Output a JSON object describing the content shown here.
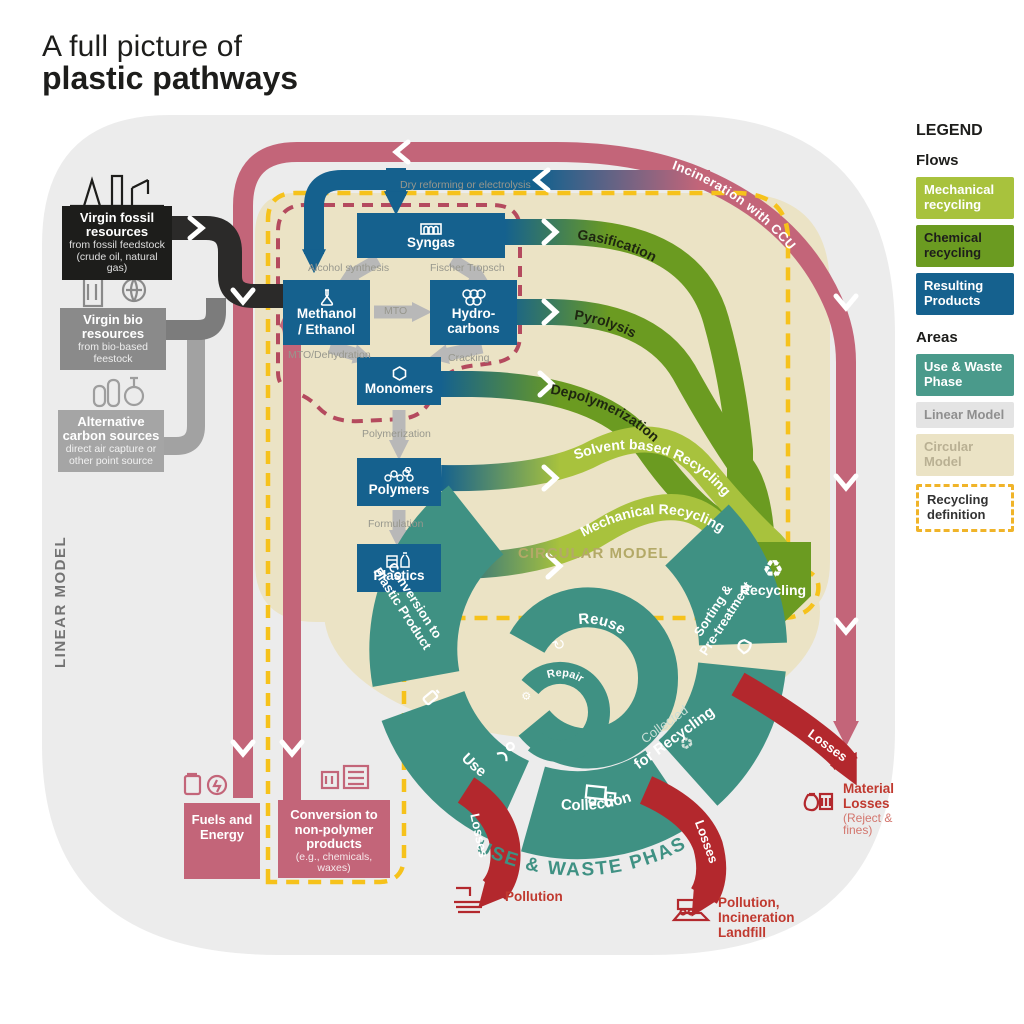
{
  "title": {
    "line1": "A full picture of",
    "line2": "plastic pathways"
  },
  "legend": {
    "title": "LEGEND",
    "flows_heading": "Flows",
    "flow_items": [
      {
        "label": "Mechanical recycling",
        "color": "#a8c23d"
      },
      {
        "label": "Chemical recycling",
        "color": "#6b9b21"
      },
      {
        "label": "Resulting Products",
        "color": "#15618e"
      }
    ],
    "areas_heading": "Areas",
    "area_items": [
      {
        "label": "Use & Waste Phase",
        "color": "#4a9a8b"
      },
      {
        "label": "Linear Model",
        "color": "#e4e4e4"
      },
      {
        "label": "Circular Model",
        "color": "#ebe3c5"
      },
      {
        "label": "Recycling definition",
        "color": "#ffffff"
      }
    ]
  },
  "sources": [
    {
      "title": "Virgin fossil resources",
      "subtitle": "from fossil feedstock (crude oil, natural gas)"
    },
    {
      "title": "Virgin bio resources",
      "subtitle": "from bio-based feestock"
    },
    {
      "title": "Alternative carbon sources",
      "subtitle": "direct air capture or other point source"
    }
  ],
  "areas": {
    "linear": "LINEAR MODEL",
    "circular": "CIRCULAR MODEL",
    "use_waste": "USE & WASTE PHASE"
  },
  "nodes": {
    "syngas": "Syngas",
    "methanol": [
      "Methanol",
      "/ Ethanol"
    ],
    "hydrocarbons": [
      "Hydro-",
      "carbons"
    ],
    "monomers": "Monomers",
    "polymers": "Polymers",
    "plastics": "Plastics"
  },
  "process_labels": {
    "dry_reforming": "Dry reforming or electrolysis",
    "alcohol": "Alcohol synthesis",
    "fischer": "Fischer Tropsch",
    "mto": "MTO",
    "mto_dehydration": "MTO/Dehydration",
    "cracking": "Cracking",
    "polymerization": "Polymerization",
    "formulation": "Formulation"
  },
  "recycling_flows": [
    {
      "label": "Gasification",
      "type": "chemical"
    },
    {
      "label": "Pyrolysis",
      "type": "chemical"
    },
    {
      "label": "Depolymerization",
      "type": "chemical"
    },
    {
      "label": "Solvent based Recycling",
      "type": "mechanical"
    },
    {
      "label": "Mechanical Recycling",
      "type": "mechanical"
    }
  ],
  "recycling_label": "Recycling",
  "ccu_label": "Incineration with CCU",
  "cycle": {
    "conversion_line1": "Conversion to",
    "conversion_line2": "Plastic Product",
    "use": "Use",
    "reuse": "Reuse",
    "repair": "Repair",
    "collection": "Collection",
    "collected_pre": "Collected",
    "collected_main": "for Recycling",
    "sorting_line1": "Sorting &",
    "sorting_line2": "Pre-treatment"
  },
  "outputs": {
    "fuels": {
      "title": "Fuels and Energy"
    },
    "nonpolymer": {
      "title": "Conversion to non-polymer products",
      "subtitle": "(e.g., chemicals, waxes)"
    }
  },
  "losses": {
    "label": "Losses",
    "pollution": "Pollution",
    "incineration_lines": [
      "Pollution,",
      "Incineration",
      "Landfill"
    ],
    "material_title": "Material Losses",
    "material_subtitle": "(Reject & fines)"
  },
  "icons": {
    "reuse": "↻",
    "repair": "⚙",
    "recycle": "♻"
  },
  "colors": {
    "mechanical_green": "#a8c23d",
    "chemical_green": "#6b9b21",
    "resulting_blue": "#15618e",
    "use_waste_teal": "#3f9183",
    "linear_gray": "#ececec",
    "circular_beige": "#ebe3c5",
    "recycling_yellow": "#f6c21b",
    "incineration_maroon": "#c36579",
    "losses_red": "#b3282d",
    "ccu_dashed_red": "#b44a5e"
  }
}
